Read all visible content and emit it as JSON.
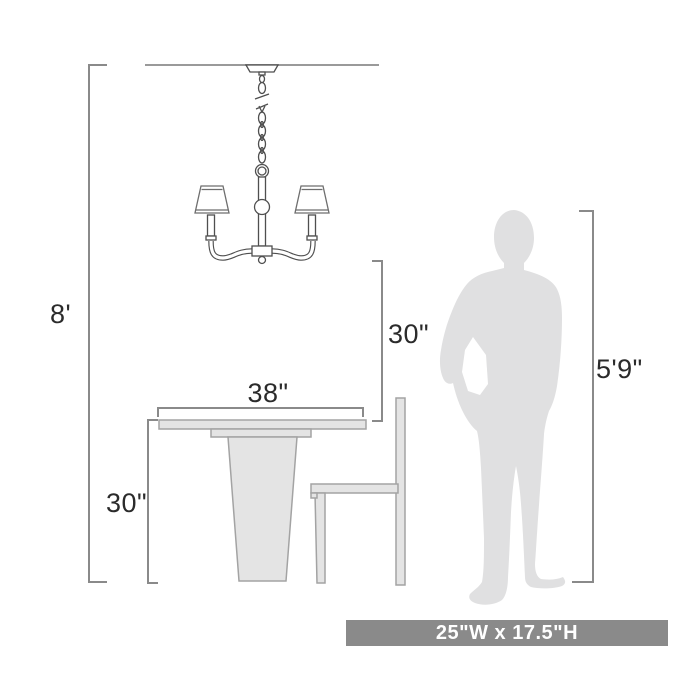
{
  "colors": {
    "background": "#ffffff",
    "dimension_line": "#8a8a8a",
    "drawing_line": "#4f4f4f",
    "furniture_fill": "#e4e4e4",
    "furniture_stroke": "#a3a3a3",
    "silhouette": "#e0e0e1",
    "banner_bg": "#8a8a8a",
    "banner_text": "#ffffff",
    "label_text": "#2b2b2b"
  },
  "dimensions": {
    "ceiling_height": {
      "label": "8'"
    },
    "clearance_below_fixture": {
      "label": "30\""
    },
    "table_width": {
      "label": "38\""
    },
    "table_height": {
      "label": "30\""
    },
    "person_height": {
      "label": "5'9\""
    }
  },
  "banner": {
    "label": "25\"W x 17.5\"H"
  },
  "figures": [
    "chandelier",
    "dining-table",
    "chair",
    "person-silhouette"
  ]
}
